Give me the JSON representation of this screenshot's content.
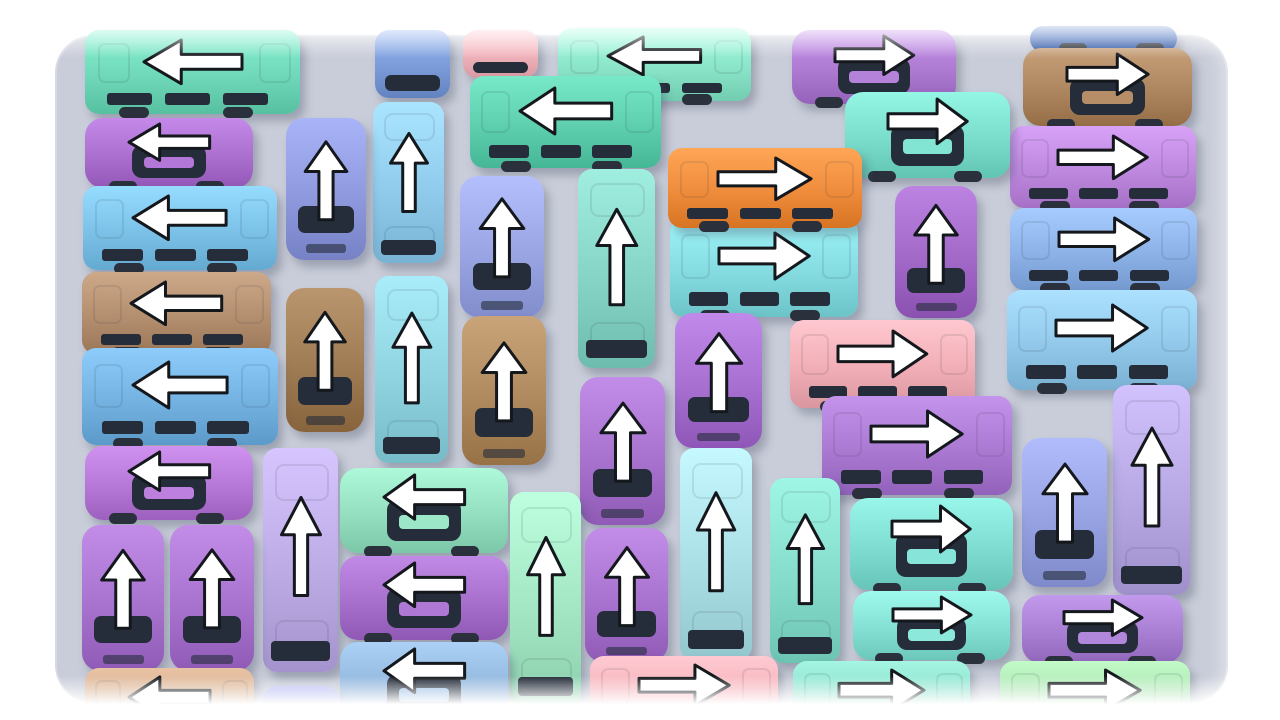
{
  "scene": {
    "background_color": "#ffffff",
    "board": {
      "x": 55,
      "y": 35,
      "width": 1173,
      "height": 668,
      "radius": 38,
      "color": "#c9cdd9"
    },
    "glass_color": "#252d3a",
    "arrow_style": {
      "fill": "#ffffff",
      "stroke": "#14181d",
      "stroke_width": 3
    },
    "top_fade": "white-gradient",
    "bottom_fade": "white-gradient"
  },
  "vehicles": [
    {
      "id": "navy-bus-sliver-top-right",
      "x": 1030,
      "y": 26,
      "w": 147,
      "h": 26,
      "color": "#3c64b4",
      "type": "strip",
      "orient": "h",
      "arrow": null
    },
    {
      "id": "blue-van-top-center",
      "x": 375,
      "y": 30,
      "w": 75,
      "h": 68,
      "color": "#7b9bd8",
      "type": "van",
      "orient": "v",
      "arrow": null
    },
    {
      "id": "pink-car-top-center",
      "x": 463,
      "y": 30,
      "w": 75,
      "h": 48,
      "color": "#f0b2ba",
      "type": "van",
      "orient": "v",
      "arrow": null
    },
    {
      "id": "mint-bus-top-center",
      "x": 558,
      "y": 28,
      "w": 193,
      "h": 73,
      "color": "#8ae4c8",
      "type": "bus",
      "orient": "h",
      "arrow": "left"
    },
    {
      "id": "teal-bus-row1-left",
      "x": 85,
      "y": 30,
      "w": 215,
      "h": 84,
      "color": "#6fd8b8",
      "type": "bus",
      "orient": "h",
      "arrow": "left"
    },
    {
      "id": "purple-car-top-right-center",
      "x": 792,
      "y": 30,
      "w": 164,
      "h": 74,
      "color": "#ad7ad2",
      "type": "car",
      "orient": "h",
      "arrow": "right"
    },
    {
      "id": "brown-car-top-right",
      "x": 1023,
      "y": 48,
      "w": 169,
      "h": 78,
      "color": "#ad8660",
      "type": "car",
      "orient": "h",
      "arrow": "right"
    },
    {
      "id": "orchid-bus-right-row2",
      "x": 1010,
      "y": 126,
      "w": 186,
      "h": 82,
      "color": "#bd88de",
      "type": "bus",
      "orient": "h",
      "arrow": "right"
    },
    {
      "id": "purple-car-row2-left",
      "x": 85,
      "y": 118,
      "w": 168,
      "h": 70,
      "color": "#ab6fd0",
      "type": "car",
      "orient": "h",
      "arrow": "left"
    },
    {
      "id": "teal-bus-row2-center",
      "x": 470,
      "y": 76,
      "w": 191,
      "h": 92,
      "color": "#5ecfae",
      "type": "bus",
      "orient": "h",
      "arrow": "left"
    },
    {
      "id": "teal-car-top-right-center",
      "x": 845,
      "y": 92,
      "w": 165,
      "h": 86,
      "color": "#7adcca",
      "type": "car",
      "orient": "h",
      "arrow": "right"
    },
    {
      "id": "sky-bus-row3-left",
      "x": 83,
      "y": 186,
      "w": 194,
      "h": 84,
      "color": "#7cc2e8",
      "type": "bus",
      "orient": "h",
      "arrow": "left"
    },
    {
      "id": "sky-vbus-col4",
      "x": 373,
      "y": 102,
      "w": 71,
      "h": 161,
      "color": "#90cbec",
      "type": "bus",
      "orient": "v",
      "arrow": "up"
    },
    {
      "id": "periwinkle-car-col3-top",
      "x": 286,
      "y": 118,
      "w": 80,
      "h": 142,
      "color": "#8f9ade",
      "type": "car",
      "orient": "v",
      "arrow": "up"
    },
    {
      "id": "periwinkle-car-col5",
      "x": 460,
      "y": 176,
      "w": 84,
      "h": 141,
      "color": "#9aa5e4",
      "type": "car",
      "orient": "v",
      "arrow": "up"
    },
    {
      "id": "teal-vbus-col6",
      "x": 578,
      "y": 169,
      "w": 77,
      "h": 199,
      "color": "#86d4c6",
      "type": "bus",
      "orient": "v",
      "arrow": "up"
    },
    {
      "id": "cornflower-bus-right-row3",
      "x": 1010,
      "y": 208,
      "w": 187,
      "h": 82,
      "color": "#8cb2e8",
      "type": "bus",
      "orient": "h",
      "arrow": "right"
    },
    {
      "id": "cyan-bus-center-row3",
      "x": 670,
      "y": 218,
      "w": 188,
      "h": 99,
      "color": "#84dbe0",
      "type": "bus",
      "orient": "h",
      "arrow": "right"
    },
    {
      "id": "orange-bus-center",
      "x": 668,
      "y": 148,
      "w": 194,
      "h": 80,
      "color": "#ee8c3c",
      "type": "bus",
      "orient": "h",
      "arrow": "right"
    },
    {
      "id": "purple-car-center-col8",
      "x": 895,
      "y": 186,
      "w": 82,
      "h": 132,
      "color": "#a269c8",
      "type": "car",
      "orient": "v",
      "arrow": "up"
    },
    {
      "id": "brown-bus-row4-left",
      "x": 82,
      "y": 272,
      "w": 189,
      "h": 82,
      "color": "#b38f70",
      "type": "bus",
      "orient": "h",
      "arrow": "left"
    },
    {
      "id": "brown-car-col3",
      "x": 286,
      "y": 288,
      "w": 78,
      "h": 144,
      "color": "#a07c55",
      "type": "car",
      "orient": "v",
      "arrow": "up"
    },
    {
      "id": "cyan-vbus-col4",
      "x": 375,
      "y": 276,
      "w": 73,
      "h": 187,
      "color": "#8fd3e0",
      "type": "bus",
      "orient": "v",
      "arrow": "up"
    },
    {
      "id": "brown-car-col5",
      "x": 462,
      "y": 316,
      "w": 84,
      "h": 149,
      "color": "#b08a5f",
      "type": "car",
      "orient": "v",
      "arrow": "up"
    },
    {
      "id": "sky-bus-right-row4",
      "x": 1007,
      "y": 290,
      "w": 190,
      "h": 100,
      "color": "#92c8ea",
      "type": "bus",
      "orient": "h",
      "arrow": "right"
    },
    {
      "id": "pink-bus-center",
      "x": 790,
      "y": 320,
      "w": 185,
      "h": 88,
      "color": "#f2aeb6",
      "type": "bus",
      "orient": "h",
      "arrow": "right"
    },
    {
      "id": "purple-car-center-col7",
      "x": 675,
      "y": 313,
      "w": 87,
      "h": 135,
      "color": "#a76fd0",
      "type": "car",
      "orient": "v",
      "arrow": "up"
    },
    {
      "id": "blue-bus-row5-left",
      "x": 82,
      "y": 348,
      "w": 196,
      "h": 97,
      "color": "#74b2e2",
      "type": "bus",
      "orient": "h",
      "arrow": "left"
    },
    {
      "id": "orchid-bus-center-right",
      "x": 822,
      "y": 396,
      "w": 190,
      "h": 99,
      "color": "#aa79d2",
      "type": "bus",
      "orient": "h",
      "arrow": "right"
    },
    {
      "id": "purple-car-col6-mid",
      "x": 580,
      "y": 377,
      "w": 85,
      "h": 148,
      "color": "#a873ce",
      "type": "car",
      "orient": "v",
      "arrow": "up"
    },
    {
      "id": "lavender-vbus-right",
      "x": 1113,
      "y": 385,
      "w": 77,
      "h": 210,
      "color": "#b7a8e4",
      "type": "bus",
      "orient": "v",
      "arrow": "up"
    },
    {
      "id": "periwinkle-car-right",
      "x": 1022,
      "y": 438,
      "w": 85,
      "h": 149,
      "color": "#97a2e2",
      "type": "car",
      "orient": "v",
      "arrow": "up"
    },
    {
      "id": "orchid-car-row6-left",
      "x": 85,
      "y": 446,
      "w": 168,
      "h": 74,
      "color": "#b678d6",
      "type": "car",
      "orient": "h",
      "arrow": "left"
    },
    {
      "id": "lavender-vbus-col3",
      "x": 263,
      "y": 448,
      "w": 75,
      "h": 224,
      "color": "#bcabe4",
      "type": "bus",
      "orient": "v",
      "arrow": "up"
    },
    {
      "id": "mint-car-center-left",
      "x": 340,
      "y": 468,
      "w": 168,
      "h": 85,
      "color": "#93dfc0",
      "type": "car",
      "orient": "h",
      "arrow": "left"
    },
    {
      "id": "pale-cyan-vbus-col7",
      "x": 680,
      "y": 448,
      "w": 72,
      "h": 212,
      "color": "#abdfe6",
      "type": "bus",
      "orient": "v",
      "arrow": "up"
    },
    {
      "id": "aqua-vbus-col8",
      "x": 770,
      "y": 478,
      "w": 70,
      "h": 185,
      "color": "#85dcca",
      "type": "bus",
      "orient": "v",
      "arrow": "up"
    },
    {
      "id": "teal-car-right-mid",
      "x": 850,
      "y": 498,
      "w": 163,
      "h": 92,
      "color": "#7edcd0",
      "type": "car",
      "orient": "h",
      "arrow": "right"
    },
    {
      "id": "purple-car-bottom-left-1",
      "x": 82,
      "y": 525,
      "w": 82,
      "h": 146,
      "color": "#a873ce",
      "type": "car",
      "orient": "v",
      "arrow": "up"
    },
    {
      "id": "purple-car-bottom-left-2",
      "x": 170,
      "y": 525,
      "w": 84,
      "h": 146,
      "color": "#a873ce",
      "type": "car",
      "orient": "v",
      "arrow": "up"
    },
    {
      "id": "purple-car-center-left-row7",
      "x": 340,
      "y": 556,
      "w": 168,
      "h": 84,
      "color": "#a770cc",
      "type": "car",
      "orient": "h",
      "arrow": "left"
    },
    {
      "id": "mint-vbus-col5-bottom",
      "x": 510,
      "y": 492,
      "w": 71,
      "h": 215,
      "color": "#a3e6c4",
      "type": "bus",
      "orient": "v",
      "arrow": "up"
    },
    {
      "id": "purple-car-col6-bottom",
      "x": 585,
      "y": 528,
      "w": 83,
      "h": 134,
      "color": "#a873ce",
      "type": "car",
      "orient": "v",
      "arrow": "up"
    },
    {
      "id": "teal-car-right-row7",
      "x": 853,
      "y": 591,
      "w": 157,
      "h": 69,
      "color": "#84e0d2",
      "type": "car",
      "orient": "h",
      "arrow": "right"
    },
    {
      "id": "purple-car-bottom-right",
      "x": 1022,
      "y": 595,
      "w": 161,
      "h": 68,
      "color": "#a97fd4",
      "type": "car",
      "orient": "h",
      "arrow": "right"
    },
    {
      "id": "steel-car-bottom-left-center",
      "x": 340,
      "y": 642,
      "w": 168,
      "h": 84,
      "color": "#92b7dc",
      "type": "car",
      "orient": "h",
      "arrow": "left"
    },
    {
      "id": "pink-bus-bottom-center",
      "x": 590,
      "y": 656,
      "w": 188,
      "h": 78,
      "color": "#f4b0b8",
      "type": "bus",
      "orient": "h",
      "arrow": "right"
    },
    {
      "id": "aqua-bus-bottom-center-right",
      "x": 793,
      "y": 661,
      "w": 177,
      "h": 78,
      "color": "#8adcc8",
      "type": "bus",
      "orient": "h",
      "arrow": "right"
    },
    {
      "id": "green-bus-bottom-right",
      "x": 1000,
      "y": 661,
      "w": 190,
      "h": 78,
      "color": "#a8e0ae",
      "type": "bus",
      "orient": "h",
      "arrow": "right"
    },
    {
      "id": "tan-bus-bottom-left",
      "x": 85,
      "y": 668,
      "w": 169,
      "h": 78,
      "color": "#cfa98a",
      "type": "bus",
      "orient": "h",
      "arrow": "left"
    },
    {
      "id": "periwinkle-van-bottom-partial",
      "x": 263,
      "y": 686,
      "w": 76,
      "h": 40,
      "color": "#a2a6de",
      "type": "van",
      "orient": "v",
      "arrow": null
    }
  ]
}
